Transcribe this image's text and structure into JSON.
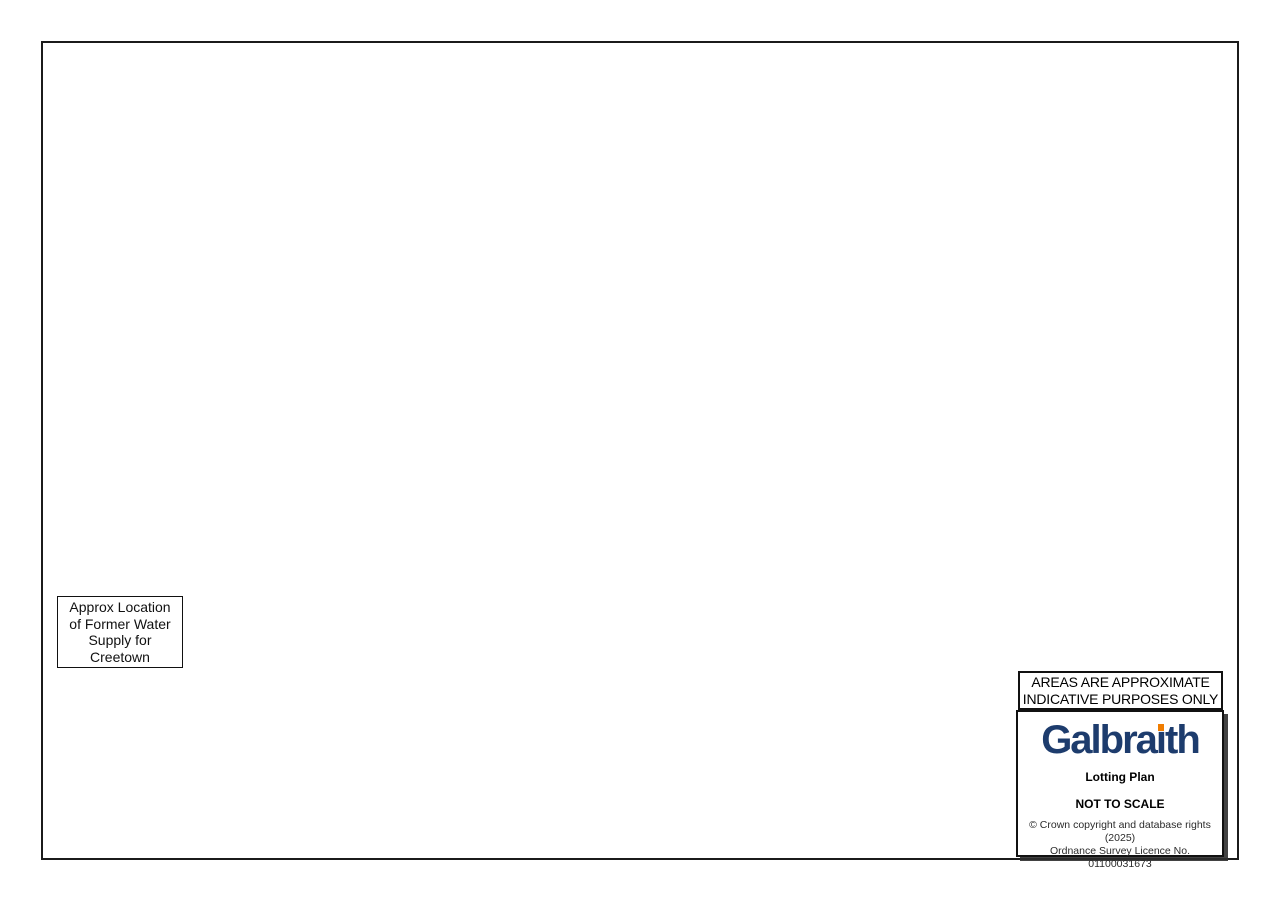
{
  "title_block": {
    "disclaimer_line1": "AREAS ARE APPROXIMATE",
    "disclaimer_line2": "INDICATIVE PURPOSES ONLY",
    "brand_pre": "Galbra",
    "brand_i": "ı",
    "brand_post": "th",
    "plan_type": "Lotting Plan",
    "scale_note": "NOT TO SCALE",
    "copyright_line1": "© Crown copyright and database rights (2025)",
    "copyright_line2": "Ordnance Survey Licence No. 01100031673"
  },
  "callout": {
    "lines": [
      "Approx Location",
      "of Former Water",
      "Supply for",
      "Creetown"
    ]
  },
  "colors": {
    "frame": "#1b1b1b",
    "grid": "#cfe5f0",
    "stream": "#8fcbe4",
    "drain": "#9ad2e8",
    "road_casing": "#cbb97e",
    "road_fill": "#f8f0cf",
    "track": "#c9c9c1",
    "woodland": "#e3f1e1",
    "moor": "#dcebe1",
    "tree": "#76a97a",
    "hachure": "#b6c0b6",
    "building": "#dfae88",
    "building_edge": "#b08357",
    "quarry": "#d8d2ca",
    "contour": "#d9cdb4",
    "navy": "#1d3c6d",
    "logo_orange": "#f07d00"
  },
  "map": {
    "lots": [
      {
        "id": "lot2",
        "label": "Lot 2",
        "area": "422.13 ac",
        "label_x": 767,
        "label_y": 558,
        "stroke": "#15669f",
        "sw": 3,
        "fill": "rgba(90,140,175,0.35)",
        "hatch": true,
        "polys": [
          "980,130 968,140 958,190 975,228 962,282 978,330 970,390 974,422 985,487 947,553 941,660 935,760 933,838 860,840 760,843 673,842 672,797 622,790 598,777 545,733 500,707 550,592 688,445 737,437 756,431 752,413 773,410 772,392 770,385 758,378 735,368 705,340 678,320 665,318 662,312 710,260 780,225 840,195 900,163"
        ]
      },
      {
        "id": "lot3",
        "label": "Lot 3",
        "area": "73.03 ac",
        "label_x": 993,
        "label_y": 200,
        "stroke": "#ec8200",
        "sw": 3,
        "fill": "rgba(245,160,50,0.33)",
        "hatch": true,
        "polys": [
          "1087,83 1091,100 1096,128 1108,158 1101,200 1085,245 1068,285 1048,330 1040,348 1010,420 985,487 974,422 970,390 978,330 962,282 975,228 958,190 968,140 980,130 1000,118 1030,100 1060,90"
        ]
      },
      {
        "id": "lot2b",
        "label": "Lot 2",
        "area": "12.59 ac",
        "label_x": 1166,
        "label_y": 133,
        "stroke": "#15669f",
        "sw": 3,
        "fill": "rgba(90,140,175,0.30)",
        "hatch": true,
        "polys": [
          "1088,82 1098,70 1112,64 1125,62 1140,68 1152,73 1162,65 1180,68 1203,91 1175,112 1155,130 1140,150 1132,168 1120,152 1108,140 1096,128 1091,100"
        ]
      },
      {
        "id": "lot1",
        "label": "Lot 1",
        "area": "176.6 ac",
        "label_x": 385,
        "label_y": 410,
        "stroke": "#cf1515",
        "sw": 2.8,
        "fill": "rgba(237,95,95,0.24)",
        "hatch": false,
        "polys": [
          "608,238 620,258 640,288 652,302 665,318 678,320 705,340 735,368 758,378 770,385 772,392 773,410 752,413 756,431 737,437 700,408 658,371 643,374 600,402 525,440 489,468 453,482 443,490 420,497 398,483 360,465 318,450 295,463 270,479 242,501 227,522 229,552 219,590 213,550 206,508 204,488 168,462 110,418 140,398 175,372 205,345 233,318 262,302 285,318 310,330 328,305 345,288 362,300 380,306 400,298 415,296 422,320 440,330 458,316 480,325 505,330 530,322 556,300 580,268"
        ]
      },
      {
        "id": "lot4",
        "label": "Lot 4",
        "area": "109.2 ac",
        "label_x": 330,
        "label_y": 585,
        "stroke": "#12a012",
        "sw": 3,
        "fill": "rgba(80,185,80,0.40)",
        "hatch": false,
        "polys": [
          "318,450 355,466 395,478 420,486 443,490 436,540 452,570 463,585 448,620 428,672 410,708 392,740 372,752 345,764 322,766 307,757 275,736 247,717 228,691 214,661 210,626 212,600 219,586 229,552 227,522 242,501 270,479 295,463"
        ]
      },
      {
        "id": "lot5",
        "label": "Lot 5",
        "area": "4.71 ac",
        "label_x": 356,
        "label_y": 825,
        "stroke": "#7d2fc0",
        "sw": 2.5,
        "fill": "rgba(160,110,210,0.28)",
        "hatch": false,
        "polys": [
          "302,753 318,747 338,744 352,751 373,758 366,772 371,790 368,801 354,805 338,790 328,798 312,784 307,768 295,760",
          "325,817 344,821 342,849 316,839"
        ]
      }
    ],
    "map_labels": [
      {
        "t": "Knockwar Hill",
        "x": 567,
        "y": 58,
        "s": 8.5
      },
      {
        "t": "148m",
        "x": 556,
        "y": 68,
        "s": 7,
        "cls": "elev"
      },
      {
        "t": "Mark Cottage",
        "x": 440,
        "y": 96,
        "s": 8
      },
      {
        "t": "138m",
        "x": 447,
        "y": 104,
        "s": 7,
        "cls": "elev"
      },
      {
        "t": "Thorny Hill",
        "x": 424,
        "y": 113,
        "s": 8.5
      },
      {
        "t": "Pibble",
        "x": 615,
        "y": 141,
        "s": 8.5
      },
      {
        "t": "Long",
        "x": 757,
        "y": 76,
        "s": 8.5
      },
      {
        "t": "Wood",
        "x": 758,
        "y": 88,
        "s": 8.5
      },
      {
        "t": "124m",
        "x": 356,
        "y": 83,
        "s": 7,
        "cls": "elev"
      },
      {
        "t": "117m",
        "x": 287,
        "y": 90,
        "s": 7,
        "cls": "elev"
      },
      {
        "t": "122m",
        "x": 209,
        "y": 179,
        "s": 7,
        "cls": "elev"
      },
      {
        "t": "131m",
        "x": 312,
        "y": 239,
        "s": 7,
        "cls": "elev"
      },
      {
        "t": "Fore",
        "x": 333,
        "y": 238,
        "s": 8
      },
      {
        "t": "Drum",
        "x": 334,
        "y": 248,
        "s": 8
      },
      {
        "t": "Back Drum",
        "x": 461,
        "y": 258,
        "s": 8
      },
      {
        "t": "380m",
        "x": 1220,
        "y": 99,
        "s": 7,
        "cls": "elev"
      },
      {
        "t": "Pibble Hill",
        "x": 1218,
        "y": 110,
        "s": 8
      },
      {
        "t": "Balloch Wood",
        "x": 97,
        "y": 453,
        "s": 8
      },
      {
        "t": "Glenquicken",
        "x": 357,
        "y": 378,
        "s": 7.5
      },
      {
        "t": "Quarry (dis)",
        "x": 357,
        "y": 387,
        "s": 7.5
      },
      {
        "t": "CG",
        "x": 497,
        "y": 477,
        "s": 7
      },
      {
        "t": "Glenquicken",
        "x": 498,
        "y": 487,
        "s": 7.5
      },
      {
        "t": "180m",
        "x": 494,
        "y": 503,
        "s": 7,
        "cls": "elev"
      },
      {
        "t": "Wind Turbine",
        "x": 508,
        "y": 528,
        "s": 7.5
      },
      {
        "t": "Glenquicken Moor",
        "x": 729,
        "y": 658,
        "s": 9.5
      },
      {
        "t": "Shiel Hill",
        "x": 747,
        "y": 674,
        "s": 8
      },
      {
        "t": "260m",
        "x": 762,
        "y": 685,
        "s": 6.5,
        "cls": "elev"
      },
      {
        "t": "Livestock Pen",
        "x": 561,
        "y": 852,
        "s": 7.5
      },
      {
        "t": "Pit (dis)",
        "x": 88,
        "y": 728,
        "s": 7
      },
      {
        "t": "Pit (dis)",
        "x": 63,
        "y": 742,
        "s": 7
      },
      {
        "t": "Garrochar",
        "x": 76,
        "y": 758,
        "s": 7
      },
      {
        "t": "Quarry (dis)",
        "x": 78,
        "y": 767,
        "s": 7
      },
      {
        "t": "Shaft",
        "x": 998,
        "y": 106,
        "s": 7
      },
      {
        "t": "Shafts",
        "x": 1018,
        "y": 131,
        "s": 7
      },
      {
        "t": "Shaft",
        "x": 1083,
        "y": 93,
        "s": 7
      },
      {
        "t": "Ford",
        "x": 393,
        "y": 352,
        "s": 7
      },
      {
        "t": "101m",
        "x": 173,
        "y": 786,
        "s": 6.5,
        "cls": "elev"
      },
      {
        "t": "OLD MILITARY ROAD",
        "x": 198,
        "y": 789,
        "s": 6.5,
        "r": 11,
        "cls": "roadlbl"
      },
      {
        "t": "Standing Stone",
        "x": 612,
        "y": 771,
        "s": 8,
        "cls": "stone"
      },
      {
        "t": "Balloch Burn",
        "x": 95,
        "y": 404,
        "s": 9,
        "r": -14,
        "cls": "water"
      },
      {
        "t": "Englishman's Burn",
        "x": 262,
        "y": 700,
        "s": 9,
        "r": 50,
        "cls": "water"
      },
      {
        "t": "Drain",
        "x": 270,
        "y": 392,
        "s": 6.5,
        "r": 80,
        "cls": "water"
      },
      {
        "t": "Drain",
        "x": 458,
        "y": 370,
        "s": 6.5,
        "r": 68,
        "cls": "water"
      },
      {
        "t": "Drain",
        "x": 334,
        "y": 522,
        "s": 6.5,
        "r": 75,
        "cls": "water"
      },
      {
        "t": "Drain",
        "x": 432,
        "y": 562,
        "s": 6.5,
        "r": 82,
        "cls": "water"
      },
      {
        "t": "Drain",
        "x": 582,
        "y": 522,
        "s": 6.5,
        "r": 60,
        "cls": "water"
      },
      {
        "t": "Drain",
        "x": 522,
        "y": 642,
        "s": 6.5,
        "r": 70,
        "cls": "water"
      },
      {
        "t": "Drain",
        "x": 285,
        "y": 663,
        "s": 6.5,
        "r": 75,
        "cls": "water"
      },
      {
        "t": "Drain",
        "x": 817,
        "y": 339,
        "s": 6.5,
        "r": 55,
        "cls": "water"
      },
      {
        "t": "Drain",
        "x": 941,
        "y": 119,
        "s": 6.5,
        "r": 70,
        "cls": "water"
      },
      {
        "t": "Drain",
        "x": 727,
        "y": 129,
        "s": 6.5,
        "r": 80,
        "cls": "water"
      },
      {
        "t": "Drain",
        "x": 612,
        "y": 302,
        "s": 6.5,
        "r": 75,
        "cls": "water"
      },
      {
        "t": "Drain",
        "x": 132,
        "y": 802,
        "s": 6.5,
        "r": 70,
        "cls": "water"
      },
      {
        "t": "Drain",
        "x": 487,
        "y": 802,
        "s": 6.5,
        "r": 80,
        "cls": "water"
      },
      {
        "t": "Drain",
        "x": 561,
        "y": 106,
        "s": 6.5,
        "r": 75,
        "cls": "water"
      },
      {
        "t": "Drain",
        "x": 740,
        "y": 560,
        "s": 6.5,
        "r": 45,
        "cls": "water"
      },
      {
        "t": "Track",
        "x": 523,
        "y": 103,
        "s": 7,
        "r": 35,
        "cls": "track"
      },
      {
        "t": "Track",
        "x": 369,
        "y": 342,
        "s": 7,
        "r": 80,
        "cls": "track"
      },
      {
        "t": "Track",
        "x": 725,
        "y": 296,
        "s": 7,
        "r": 14,
        "cls": "track"
      },
      {
        "t": "Track",
        "x": 906,
        "y": 576,
        "s": 7,
        "r": 40,
        "cls": "track"
      },
      {
        "t": "Track",
        "x": 541,
        "y": 813,
        "s": 7,
        "r": 4,
        "cls": "track"
      },
      {
        "t": "Track",
        "x": 90,
        "y": 593,
        "s": 7,
        "r": 75,
        "cls": "track"
      },
      {
        "t": "Track",
        "x": 398,
        "y": 428,
        "s": 7,
        "r": 78,
        "cls": "track"
      }
    ]
  }
}
